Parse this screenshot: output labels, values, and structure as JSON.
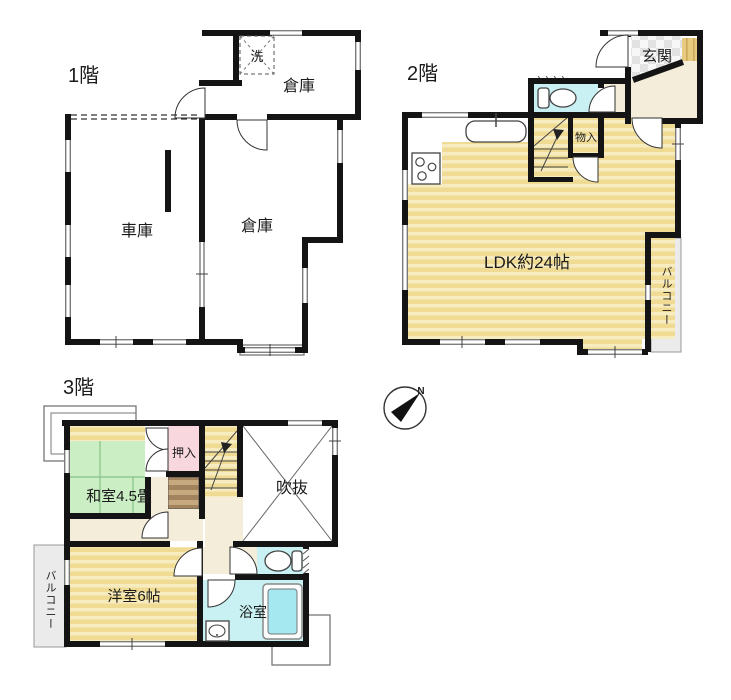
{
  "palette": {
    "wall": "#141414",
    "wood_floor": "#F0DB95",
    "wood_floor_stripe": "#F7ECC0",
    "wood_vertical": "#E6CB80",
    "wood_vertical_line": "#CDA75B",
    "tatami": "#CBEEC4",
    "tatami_line": "#88C288",
    "pink": "#F8D7DE",
    "cyan": "#C9F0F3",
    "tub": "#A6E8F0",
    "cream": "#F3EDDA",
    "balcony": "#EBEBEB",
    "tile": "#E2E2E2",
    "tile_bg": "#F7F7F7",
    "brown": "#A3825E",
    "brown_stripe": "#C7A980"
  },
  "compass": {
    "north": "N"
  },
  "floors": {
    "f1": {
      "label": "1階",
      "rooms": {
        "laundry": "洗",
        "storage_top": "倉庫",
        "garage": "車庫",
        "storage": "倉庫"
      }
    },
    "f2": {
      "label": "2階",
      "rooms": {
        "entrance": "玄関",
        "closet": "物入",
        "ldk": "LDK約24帖",
        "balcony": "バルコニー"
      }
    },
    "f3": {
      "label": "3階",
      "rooms": {
        "oshiire": "押入",
        "atrium": "吹抜",
        "japanese_room": "和室4.5畳",
        "western_room": "洋室6帖",
        "bath": "浴室",
        "balcony": "バルコニー"
      }
    }
  }
}
